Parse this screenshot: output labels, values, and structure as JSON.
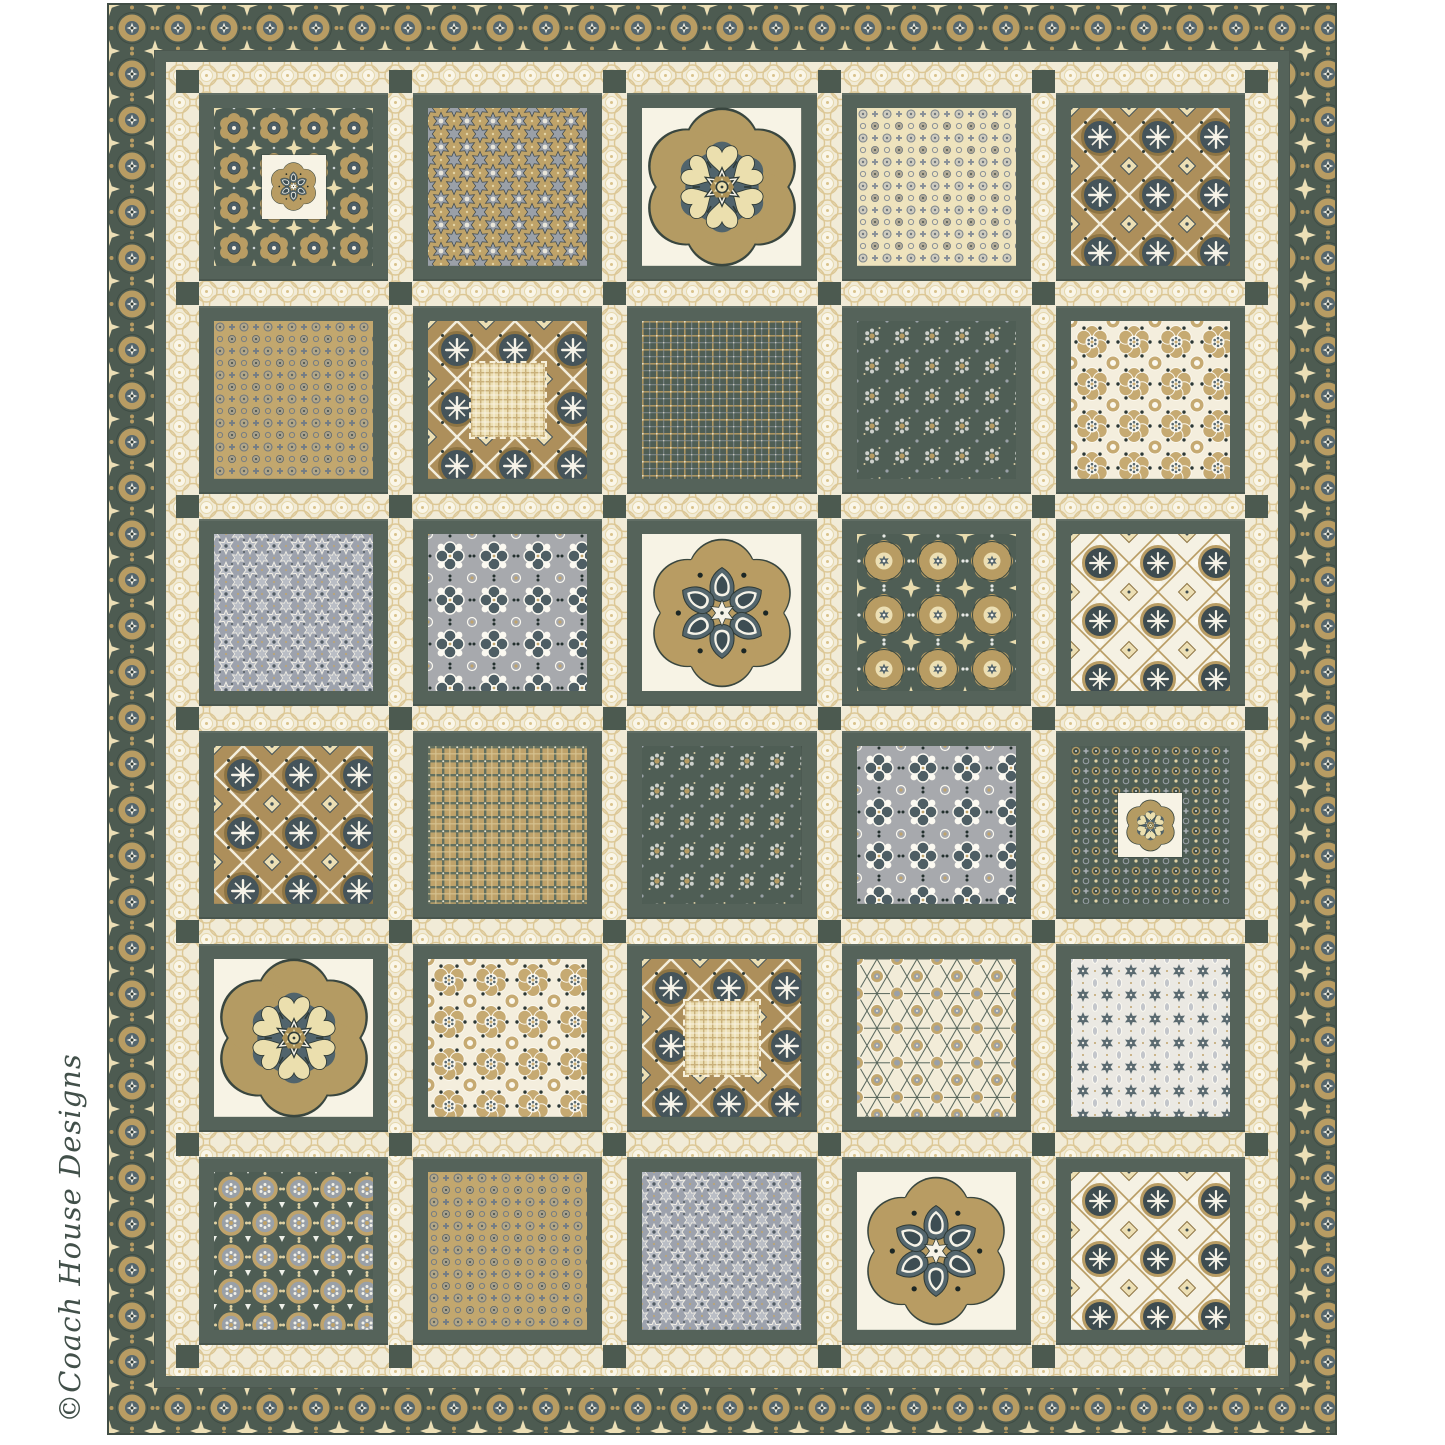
{
  "artwork": {
    "credit": "©Coach House Designs"
  },
  "palette": {
    "page_background": "#ffffff",
    "binding_edge": "#414e46",
    "border_green": "#4d5b51",
    "frame_green": "#55635a",
    "cornerstone_green": "#4c5a50",
    "sashing_cream": "#f1ebd7",
    "tan_gold": "#b89c63",
    "slate_blue": "#54666d",
    "cream_motif": "#ecdfb4",
    "gray_fabric": "#9da2ad",
    "medallion_background": "#f7f3e5",
    "credit_text": "#42504a"
  },
  "quilt": {
    "rows": 6,
    "cols": 5,
    "fabric_patterns": {
      "dark-green-floral": "p-dkfloral",
      "tan-stars": "p-tanstars",
      "medallion-cream": "p-medbg",
      "cream-circle-dots": "p-creamdots",
      "dark-tile": "p-tiledark",
      "tan-circle-dots": "p-tandots",
      "green-plaid": "p-greenplaid",
      "green-small-floral": "p-greensmall",
      "cream-floral-tile": "p-creamtile",
      "gray-stars": "p-graystars",
      "gray-floral-tile": "p-graytile",
      "green-kaleidoscope": "p-greenkaleido",
      "light-tile": "p-tilelight",
      "tan-plaid": "p-tanplaid",
      "green-circle-dots": "p-greendots",
      "cream-hex-lattice": "p-creamhex",
      "gray-diamond-stars": "p-graydiamond",
      "green-rings": "p-greenrings"
    },
    "blocks": [
      {
        "row": 1,
        "col": 1,
        "fabric": "dark-green-floral",
        "overlay": "seed-medallion-mini"
      },
      {
        "row": 1,
        "col": 2,
        "fabric": "tan-stars",
        "overlay": null
      },
      {
        "row": 1,
        "col": 3,
        "fabric": "medallion-cream",
        "overlay": "heart-medallion-large"
      },
      {
        "row": 1,
        "col": 4,
        "fabric": "cream-circle-dots",
        "overlay": null
      },
      {
        "row": 1,
        "col": 5,
        "fabric": "dark-tile",
        "overlay": null
      },
      {
        "row": 2,
        "col": 1,
        "fabric": "tan-circle-dots",
        "overlay": null
      },
      {
        "row": 2,
        "col": 2,
        "fabric": "dark-tile",
        "overlay": "plaid-patch"
      },
      {
        "row": 2,
        "col": 3,
        "fabric": "green-plaid",
        "overlay": null
      },
      {
        "row": 2,
        "col": 4,
        "fabric": "green-small-floral",
        "overlay": null
      },
      {
        "row": 2,
        "col": 5,
        "fabric": "cream-floral-tile",
        "overlay": null
      },
      {
        "row": 3,
        "col": 1,
        "fabric": "gray-stars",
        "overlay": null
      },
      {
        "row": 3,
        "col": 2,
        "fabric": "gray-floral-tile",
        "overlay": null
      },
      {
        "row": 3,
        "col": 3,
        "fabric": "medallion-cream",
        "overlay": "seed-medallion-large"
      },
      {
        "row": 3,
        "col": 4,
        "fabric": "green-kaleidoscope",
        "overlay": null
      },
      {
        "row": 3,
        "col": 5,
        "fabric": "light-tile",
        "overlay": null
      },
      {
        "row": 4,
        "col": 1,
        "fabric": "dark-tile",
        "overlay": null
      },
      {
        "row": 4,
        "col": 2,
        "fabric": "tan-plaid",
        "overlay": null
      },
      {
        "row": 4,
        "col": 3,
        "fabric": "green-small-floral",
        "overlay": null
      },
      {
        "row": 4,
        "col": 4,
        "fabric": "gray-floral-tile",
        "overlay": null
      },
      {
        "row": 4,
        "col": 5,
        "fabric": "green-circle-dots",
        "overlay": "heart-medallion-mini"
      },
      {
        "row": 5,
        "col": 1,
        "fabric": "medallion-cream",
        "overlay": "heart-medallion-large"
      },
      {
        "row": 5,
        "col": 2,
        "fabric": "cream-floral-tile",
        "overlay": null
      },
      {
        "row": 5,
        "col": 3,
        "fabric": "dark-tile",
        "overlay": "plaid-patch"
      },
      {
        "row": 5,
        "col": 4,
        "fabric": "cream-hex-lattice",
        "overlay": null
      },
      {
        "row": 5,
        "col": 5,
        "fabric": "gray-diamond-stars",
        "overlay": null
      },
      {
        "row": 6,
        "col": 1,
        "fabric": "green-rings",
        "overlay": null
      },
      {
        "row": 6,
        "col": 2,
        "fabric": "tan-circle-dots",
        "overlay": null
      },
      {
        "row": 6,
        "col": 3,
        "fabric": "gray-stars",
        "overlay": null
      },
      {
        "row": 6,
        "col": 4,
        "fabric": "medallion-cream",
        "overlay": "seed-medallion-large"
      },
      {
        "row": 6,
        "col": 5,
        "fabric": "light-tile",
        "overlay": null
      }
    ]
  }
}
